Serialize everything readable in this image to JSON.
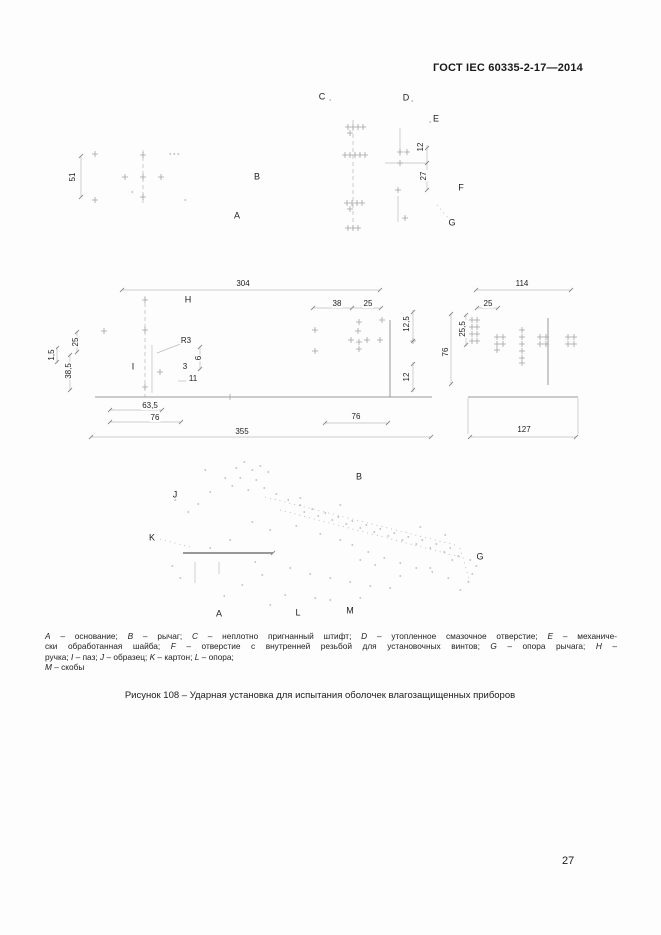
{
  "header": {
    "title": "ГОСТ IEC 60335-2-17—2014"
  },
  "figure": {
    "part_labels": [
      {
        "t": "C",
        "x": 322,
        "y": 97
      },
      {
        "t": "D",
        "x": 406,
        "y": 98
      },
      {
        "t": "E",
        "x": 436,
        "y": 119
      },
      {
        "t": "F",
        "x": 461,
        "y": 188
      },
      {
        "t": "G",
        "x": 452,
        "y": 223
      },
      {
        "t": "B",
        "x": 257,
        "y": 177
      },
      {
        "t": "A",
        "x": 237,
        "y": 216
      },
      {
        "t": "H",
        "x": 188,
        "y": 300
      },
      {
        "t": "I",
        "x": 133,
        "y": 367
      },
      {
        "t": "J",
        "x": 175,
        "y": 495
      },
      {
        "t": "B",
        "x": 359,
        "y": 477
      },
      {
        "t": "K",
        "x": 152,
        "y": 538
      },
      {
        "t": "G",
        "x": 480,
        "y": 557
      },
      {
        "t": "A",
        "x": 219,
        "y": 614
      },
      {
        "t": "L",
        "x": 298,
        "y": 613
      },
      {
        "t": "M",
        "x": 350,
        "y": 611
      }
    ],
    "dimensions": [
      {
        "t": "51",
        "x": 73,
        "y": 177,
        "rot": true
      },
      {
        "t": "12",
        "x": 421,
        "y": 147,
        "rot": true
      },
      {
        "t": "27",
        "x": 424,
        "y": 176,
        "rot": true
      },
      {
        "t": "304",
        "x": 243,
        "y": 284
      },
      {
        "t": "R3",
        "x": 186,
        "y": 341
      },
      {
        "t": "25",
        "x": 76,
        "y": 342,
        "rot": true
      },
      {
        "t": "1,5",
        "x": 52,
        "y": 355,
        "rot": true
      },
      {
        "t": "38,5",
        "x": 69,
        "y": 371,
        "rot": true
      },
      {
        "t": "3",
        "x": 185,
        "y": 367
      },
      {
        "t": "6",
        "x": 199,
        "y": 358,
        "rot": true
      },
      {
        "t": "11",
        "x": 193,
        "y": 379
      },
      {
        "t": "63,5",
        "x": 150,
        "y": 406
      },
      {
        "t": "76",
        "x": 155,
        "y": 418
      },
      {
        "t": "355",
        "x": 242,
        "y": 432
      },
      {
        "t": "38",
        "x": 337,
        "y": 304
      },
      {
        "t": "25",
        "x": 368,
        "y": 304
      },
      {
        "t": "12,5",
        "x": 407,
        "y": 324,
        "rot": true
      },
      {
        "t": "12",
        "x": 407,
        "y": 377,
        "rot": true
      },
      {
        "t": "76",
        "x": 356,
        "y": 417
      },
      {
        "t": "114",
        "x": 522,
        "y": 284
      },
      {
        "t": "25",
        "x": 488,
        "y": 304
      },
      {
        "t": "25,5",
        "x": 463,
        "y": 329,
        "rot": true
      },
      {
        "t": "76",
        "x": 446,
        "y": 352,
        "rot": true
      },
      {
        "t": "127",
        "x": 524,
        "y": 430
      }
    ],
    "legend_lines": [
      {
        "justify": true,
        "segments": [
          {
            "t": "A",
            "i": true
          },
          {
            "t": " – основание; "
          },
          {
            "t": "B",
            "i": true
          },
          {
            "t": " – рычаг; "
          },
          {
            "t": "C",
            "i": true
          },
          {
            "t": " – неплотно пригнанный штифт; "
          },
          {
            "t": "D",
            "i": true
          },
          {
            "t": " – утопленное смазочное отверстие; "
          },
          {
            "t": "E",
            "i": true
          },
          {
            "t": " – механиче-"
          }
        ]
      },
      {
        "justify": true,
        "segments": [
          {
            "t": "ски обработанная шайба; "
          },
          {
            "t": "F",
            "i": true
          },
          {
            "t": " – отверстие с внутренней резьбой для установочных винтов; "
          },
          {
            "t": "G",
            "i": true
          },
          {
            "t": " – опора рычага; "
          },
          {
            "t": "H",
            "i": true
          },
          {
            "t": " –"
          }
        ]
      },
      {
        "justify": false,
        "segments": [
          {
            "t": "ручка; "
          },
          {
            "t": "I",
            "i": true
          },
          {
            "t": " – паз; "
          },
          {
            "t": "J",
            "i": true
          },
          {
            "t": " – образец; "
          },
          {
            "t": "K",
            "i": true
          },
          {
            "t": " – картон; "
          },
          {
            "t": "L",
            "i": true
          },
          {
            "t": " – опора;"
          }
        ]
      },
      {
        "justify": false,
        "segments": [
          {
            "t": "M",
            "i": true
          },
          {
            "t": " –  скобы"
          }
        ]
      }
    ],
    "caption": "Рисунок 108 – Ударная установка для испытания оболочек влагозащищенных приборов"
  },
  "footer": {
    "page_number": "27"
  }
}
